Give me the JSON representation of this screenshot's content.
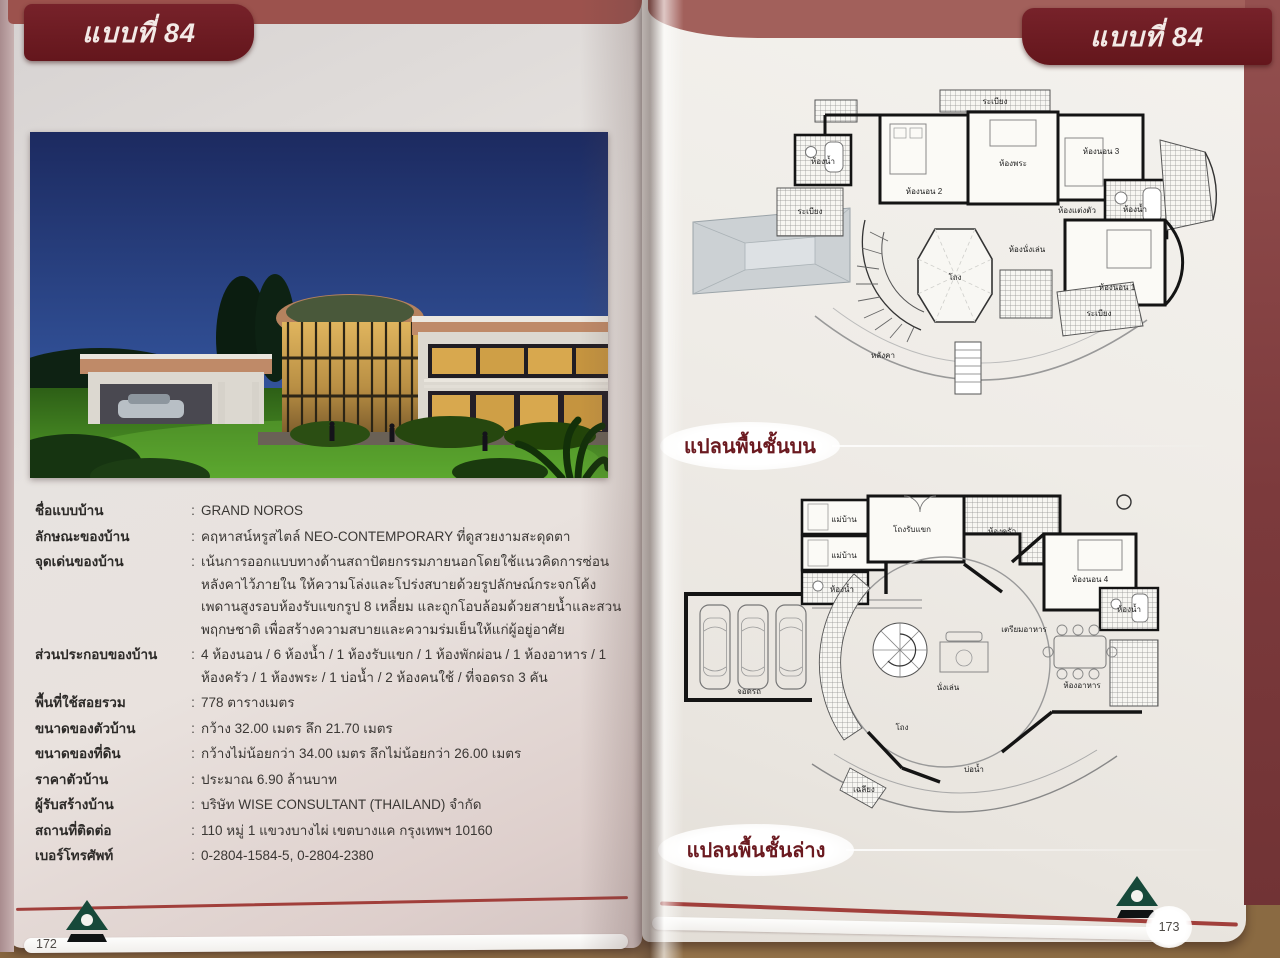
{
  "page": {
    "left_tab": "แบบที่ 84",
    "right_tab": "แบบที่ 84",
    "left_page_number": "172",
    "right_page_number": "173"
  },
  "specs": {
    "colon": ":",
    "rows": [
      {
        "label": "ชื่อแบบบ้าน",
        "value": "GRAND NOROS"
      },
      {
        "label": "ลักษณะของบ้าน",
        "value": "คฤหาสน์หรูสไตล์ NEO-CONTEMPORARY ที่ดูสวยงามสะดุดตา"
      },
      {
        "label": "จุดเด่นของบ้าน",
        "value": "เน้นการออกแบบทางด้านสถาปัตยกรรมภายนอกโดยใช้แนวคิดการซ่อนหลังคาไว้ภายใน ให้ความโล่งและโปร่งสบายด้วยรูปลักษณ์กระจกโค้งเพดานสูงรอบห้องรับแขกรูป 8 เหลี่ยม และถูกโอบล้อมด้วยสายน้ำและสวนพฤกษชาติ เพื่อสร้างความสบายและความร่มเย็นให้แก่ผู้อยู่อาศัย"
      },
      {
        "label": "ส่วนประกอบของบ้าน",
        "value": "4 ห้องนอน / 6 ห้องน้ำ / 1 ห้องรับแขก / 1 ห้องพักผ่อน / 1 ห้องอาหาร / 1 ห้องครัว / 1 ห้องพระ / 1 บ่อน้ำ / 2 ห้องคนใช้ / ที่จอดรถ 3 คัน"
      },
      {
        "label": "พื้นที่ใช้สอยรวม",
        "value": "778 ตารางเมตร"
      },
      {
        "label": "ขนาดของตัวบ้าน",
        "value": "กว้าง 32.00 เมตร ลึก 21.70 เมตร"
      },
      {
        "label": "ขนาดของที่ดิน",
        "value": "กว้างไม่น้อยกว่า 34.00 เมตร ลึกไม่น้อยกว่า 26.00 เมตร"
      },
      {
        "label": "ราคาตัวบ้าน",
        "value": "ประมาณ 6.90 ล้านบาท"
      },
      {
        "label": "ผู้รับสร้างบ้าน",
        "value": "บริษัท WISE CONSULTANT (THAILAND) จำกัด"
      },
      {
        "label": "สถานที่ติดต่อ",
        "value": "110 หมู่ 1 แขวงบางไผ่ เขตบางแค กรุงเทพฯ 10160"
      },
      {
        "label": "เบอร์โทรศัพท์",
        "value": "0-2804-1584-5, 0-2804-2380"
      }
    ]
  },
  "plans": {
    "upper_label": "แปลนพื้นชั้นบน",
    "lower_label": "แปลนพื้นชั้นล่าง",
    "upper_rooms": {
      "balcony_top": "ระเบียง",
      "bedroom2": "ห้องนอน 2",
      "prayer": "ห้องพระ",
      "bedroom3": "ห้องนอน 3",
      "bath_left": "ห้องน้ำ",
      "balcony_left": "ระเบียง",
      "dressing": "ห้องแต่งตัว",
      "bath_right": "ห้องน้ำ",
      "sitting": "ห้องนั่งเล่น",
      "bedroom1": "ห้องนอน 1",
      "balcony_right": "ระเบียง",
      "hall": "โถง",
      "roof": "หลังคา"
    },
    "lower_rooms": {
      "parking": "จอดรถ",
      "maid1": "แม่บ้าน",
      "maid2": "แม่บ้าน",
      "maid_bath": "ห้องน้ำ",
      "reception": "โถงรับแขก",
      "kitchen": "ห้องครัว",
      "pantry": "เตรียมอาหาร",
      "bedroom4": "ห้องนอน 4",
      "bath_right": "ห้องน้ำ",
      "dining": "ห้องอาหาร",
      "sitting": "นั่งเล่น",
      "hall": "โถง",
      "pond": "บ่อน้ำ",
      "terrace": "เฉลียง"
    }
  },
  "colors": {
    "tab_maroon": "#64161c",
    "band_red": "#9c524d",
    "accent_line": "#a13f3b",
    "logo_green": "#17493a",
    "badge_text": "#6b1a20"
  }
}
